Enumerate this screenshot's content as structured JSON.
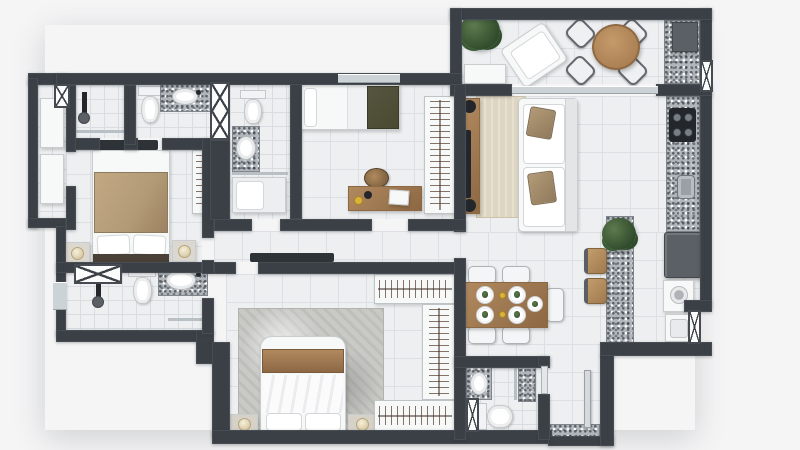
{
  "scene": {
    "type": "apartment-floor-plan",
    "view": "top-down 3D architectural render",
    "visible_text": ""
  },
  "palette": {
    "canvas": "#f5f5f6",
    "wall": "#3a4046",
    "door_leaf": "#2e3338",
    "floor": "#edeff1",
    "floor_line": "#dce0e4",
    "floor_fine_line": "#d9dde1",
    "granite_base": "#b0b6bc",
    "granite_edge": "#80868c",
    "white_furn": "#f7f8f8",
    "furn_edge": "#c9cdd0",
    "wood": "#b1895f",
    "wood_dark": "#8c6843",
    "stool": "#c49c6c",
    "tan": "#b39a77",
    "olive": "#4a4a32",
    "beige_rug": "#ded5c2",
    "gray_rug": "#c9c9c6",
    "appliance": "#5a6066",
    "appliance_dark": "#23272c",
    "glass": "#ccd3d7",
    "plant_dark": "#2f4b2b",
    "plant_light": "#5d7a4e",
    "lamp": "#f7efd8",
    "bowl_yellow": "#d9b23a"
  },
  "rooms": [
    {
      "name": "balcony",
      "items": [
        "potted-plant",
        "lounge-chair",
        "bench",
        "round-table",
        "four-chairs",
        "barbecue-counter"
      ]
    },
    {
      "name": "living-room",
      "items": [
        "sofa",
        "throw-pillows",
        "area-rug",
        "tv-console",
        "tv",
        "speakers"
      ]
    },
    {
      "name": "kitchen",
      "items": [
        "granite-counter",
        "cooktop",
        "kitchen-sink",
        "refrigerator",
        "island-counter",
        "bar-stools",
        "island-plant"
      ]
    },
    {
      "name": "service-area",
      "items": [
        "washing-machine",
        "laundry-sink",
        "vent-window"
      ]
    },
    {
      "name": "dining-area",
      "items": [
        "dining-table",
        "six-chairs",
        "place-settings"
      ]
    },
    {
      "name": "bedroom-1",
      "items": [
        "double-bed",
        "nightstands",
        "lamps",
        "wardrobe",
        "dresser"
      ]
    },
    {
      "name": "bedroom-2",
      "items": [
        "single-bed",
        "desk",
        "chair",
        "laptop",
        "wardrobe"
      ]
    },
    {
      "name": "master-bedroom",
      "items": [
        "double-bed",
        "headboard-panel",
        "nightstands",
        "lamps",
        "rug",
        "walk-in-closet"
      ]
    },
    {
      "name": "bathroom-1",
      "items": [
        "shower"
      ]
    },
    {
      "name": "bathroom-2",
      "items": [
        "toilet",
        "granite-vanity",
        "sink"
      ]
    },
    {
      "name": "bathroom-3",
      "items": [
        "toilet",
        "granite-vanity",
        "shower-bench"
      ]
    },
    {
      "name": "bathroom-4",
      "items": [
        "toilet",
        "granite-vanity",
        "shower",
        "vent-window"
      ]
    },
    {
      "name": "entry",
      "items": [
        "entry-door",
        "granite-mat"
      ]
    },
    {
      "name": "closet-room",
      "items": [
        "cabinets",
        "vent-window"
      ]
    }
  ]
}
